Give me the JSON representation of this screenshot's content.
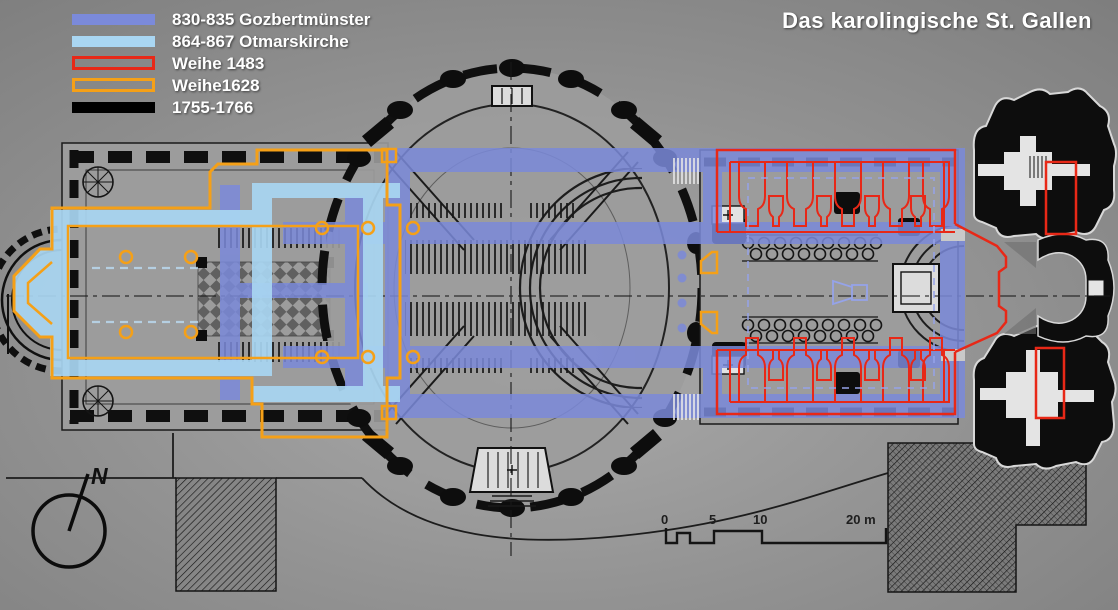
{
  "title": "Das karolingische St. Gallen",
  "colors": {
    "background": "#8d8d8d",
    "blue": "#7b8ada",
    "light_blue": "#a9d6f2",
    "red": "#e82817",
    "orange": "#f5a017",
    "black": "#000000",
    "ink": "#111111",
    "text": "#ffffff"
  },
  "legend": {
    "items": [
      {
        "label": "830-835 Gozbertmünster",
        "style": "solid",
        "color": "#7b8ada"
      },
      {
        "label": "864-867 Otmarskirche",
        "style": "solid",
        "color": "#a9d6f2"
      },
      {
        "label": "Weihe 1483",
        "style": "outline",
        "color": "#e82817"
      },
      {
        "label": "Weihe1628",
        "style": "outline",
        "color": "#f5a017"
      },
      {
        "label": "1755-1766",
        "style": "solid",
        "color": "#000000"
      }
    ]
  },
  "scale_bar": {
    "labels": [
      "0",
      "5",
      "10",
      "20 m"
    ]
  },
  "compass": {
    "label": "N"
  }
}
